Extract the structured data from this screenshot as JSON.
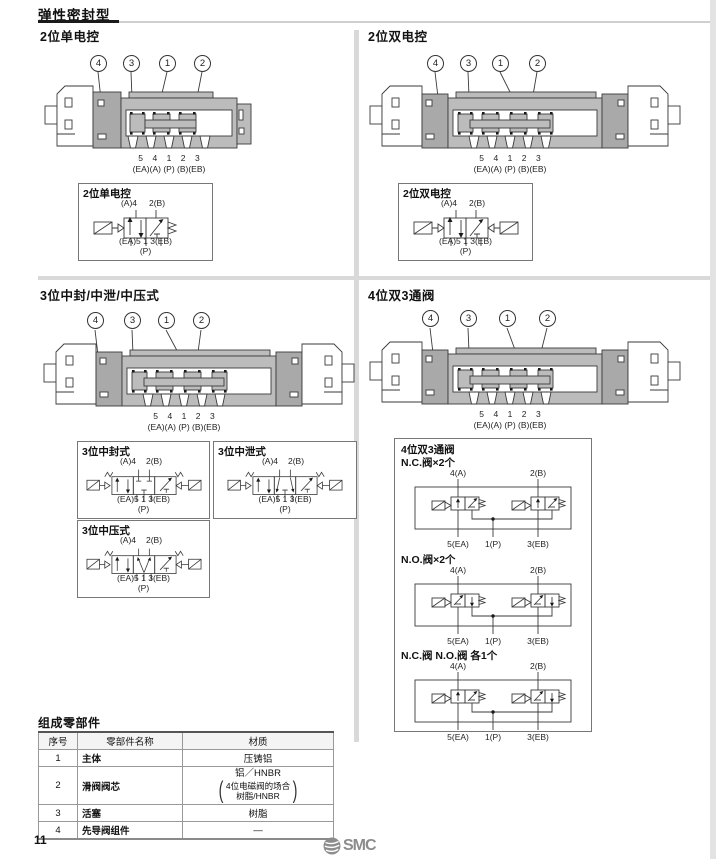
{
  "page": {
    "title": "弹性密封型",
    "page_number": "11",
    "logo_text": "SMC"
  },
  "quadrants": [
    {
      "title": "2位单电控",
      "callouts": [
        "4",
        "3",
        "1",
        "2"
      ],
      "port_numbers": "5    4    1    2    3",
      "port_names": "(EA)(A) (P) (B)(EB)",
      "schematic": {
        "title": "2位单电控",
        "top_a": "(A)4",
        "top_b": "2(B)",
        "bottom": "(EA)5 1 3(EB)",
        "p": "(P)"
      }
    },
    {
      "title": "2位双电控",
      "callouts": [
        "4",
        "3",
        "1",
        "2"
      ],
      "port_numbers": "5    4    1    2    3",
      "port_names": "(EA)(A) (P) (B)(EB)",
      "schematic": {
        "title": "2位双电控",
        "top_a": "(A)4",
        "top_b": "2(B)",
        "bottom": "(EA)5 1 3(EB)",
        "p": "(P)"
      }
    },
    {
      "title": "3位中封/中泄/中压式",
      "callouts": [
        "4",
        "3",
        "1",
        "2"
      ],
      "port_numbers": "5    4    1    2    3",
      "port_names": "(EA)(A) (P) (B)(EB)",
      "schematics": [
        {
          "title": "3位中封式",
          "top_a": "(A)4",
          "top_b": "2(B)",
          "bottom": "(EA)5 1 3(EB)",
          "p": "(P)"
        },
        {
          "title": "3位中泄式",
          "top_a": "(A)4",
          "top_b": "2(B)",
          "bottom": "(EA)5 1 3(EB)",
          "p": "(P)"
        },
        {
          "title": "3位中压式",
          "top_a": "(A)4",
          "top_b": "2(B)",
          "bottom": "(EA)5 1 3(EB)",
          "p": "(P)"
        }
      ]
    },
    {
      "title": "4位双3通阀",
      "callouts": [
        "4",
        "3",
        "1",
        "2"
      ],
      "port_numbers": "5    4    1    2    3",
      "port_names": "(EA)(A) (P) (B)(EB)",
      "panel": {
        "title": "4位双3通阀",
        "sections": [
          {
            "subtitle": "N.C.阀×2个",
            "a": "4(A)",
            "b": "2(B)",
            "ea": "5(EA)",
            "p": "1(P)",
            "eb": "3(EB)"
          },
          {
            "subtitle": "N.O.阀×2个",
            "a": "4(A)",
            "b": "2(B)",
            "ea": "5(EA)",
            "p": "1(P)",
            "eb": "3(EB)"
          },
          {
            "subtitle": "N.C.阀 N.O.阀 各1个",
            "a": "4(A)",
            "b": "2(B)",
            "ea": "5(EA)",
            "p": "1(P)",
            "eb": "3(EB)"
          }
        ]
      }
    }
  ],
  "parts": {
    "title": "组成零部件",
    "headers": [
      "序号",
      "零部件名称",
      "材质"
    ],
    "rows": [
      {
        "no": "1",
        "name": "主体",
        "material": "压铸铝"
      },
      {
        "no": "2",
        "name": "滑阀阀芯",
        "material": "铝／HNBR",
        "material_note1": "4位电磁阀的场合",
        "material_note2": "树脂/HNBR"
      },
      {
        "no": "3",
        "name": "活塞",
        "material": "树脂"
      },
      {
        "no": "4",
        "name": "先导阀组件",
        "material": "—"
      }
    ]
  }
}
